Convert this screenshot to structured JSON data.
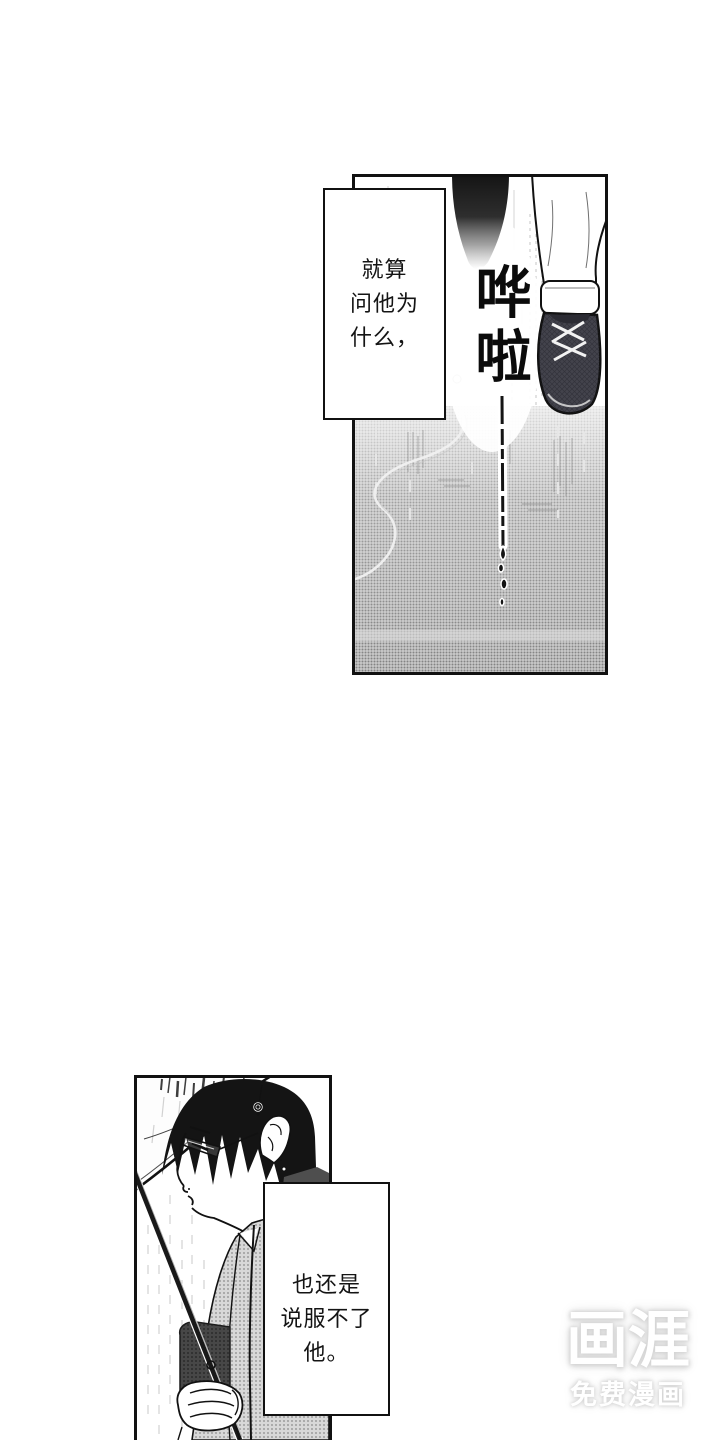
{
  "narration": {
    "box1": {
      "lines": [
        "就算",
        "问他为",
        "什么，"
      ]
    },
    "box2": {
      "lines": [
        "也还是",
        "说服不了",
        "他。"
      ]
    }
  },
  "sfx": {
    "top_panel": "哗啦"
  },
  "watermark": {
    "logo": "画涯",
    "tagline": "免费漫画"
  },
  "colors": {
    "ink": "#111111",
    "page_background": "#ffffff",
    "ground_tone": "#adadad",
    "shoe_dark": "#43434c",
    "coat_tone": "#c6c6c6",
    "watermark_text": "#ffffff",
    "watermark_glow": "#d6d6d6"
  }
}
